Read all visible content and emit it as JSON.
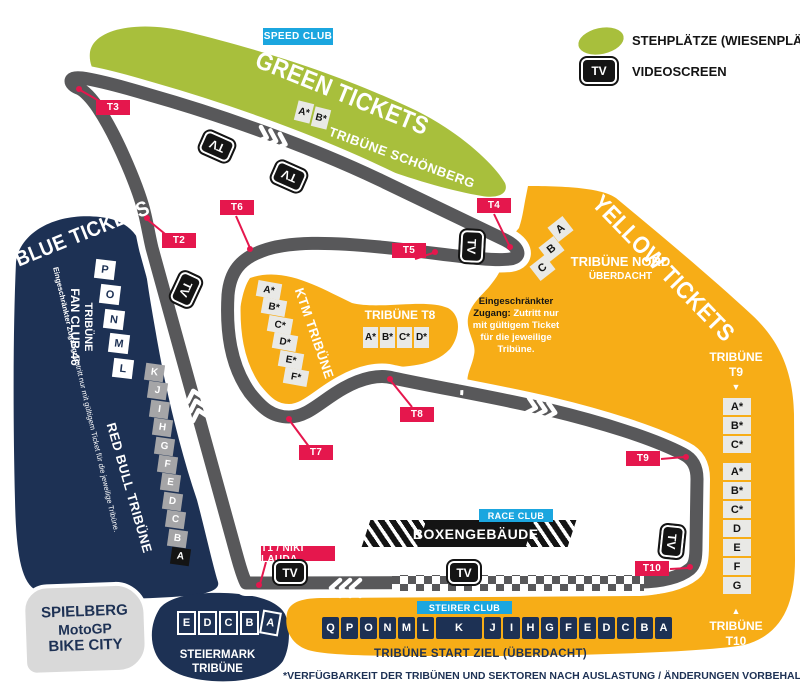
{
  "legend": {
    "standing_label": "STEHPLÄTZE (WIESENPLÄTZE)",
    "videoscreen_label": "VIDEOSCREEN",
    "tv_text": "TV"
  },
  "zones": {
    "green": {
      "title": "GREEN TICKETS",
      "club": "SPEED CLUB",
      "tribune_schoenberg": {
        "name": "TRIBÜNE SCHÖNBERG",
        "sectors": [
          "A*",
          "B*"
        ]
      }
    },
    "blue": {
      "title": "BLUE TICKETS",
      "fan_club": {
        "name_line1": "TRIBÜNE",
        "name_line2": "FAN CLUB 46",
        "sectors": [
          "P",
          "O",
          "N",
          "M",
          "L"
        ]
      },
      "red_bull": {
        "name": "RED BULL TRIBÜNE",
        "sectors": [
          "K",
          "J",
          "I",
          "H",
          "G",
          "F",
          "E",
          "D",
          "C",
          "B",
          "A"
        ]
      },
      "restricted_bold": "Eingeschränkter Zugang:",
      "restricted_rest": " Zutritt nur mit gültigem Ticket für die jeweilige Tribüne."
    },
    "yellow": {
      "title": "YELLOW TICKETS",
      "tribune_nord": {
        "name": "TRIBÜNE NORD",
        "sub": "ÜBERDACHT",
        "sectors": [
          "C",
          "B",
          "A"
        ]
      },
      "ktm": {
        "name": "KTM TRIBÜNE",
        "sectors": [
          "A*",
          "B*",
          "C*",
          "D*",
          "E*",
          "F*"
        ]
      },
      "tribune_t8": {
        "name": "TRIBÜNE T8",
        "sectors": [
          "A*",
          "B*",
          "C*",
          "D*"
        ]
      },
      "tribune_t9": {
        "name": "TRIBÜNE",
        "num": "T9",
        "arrow": "▼",
        "sectors": [
          "A*",
          "B*",
          "C*",
          "A*",
          "B*",
          "C*",
          "D",
          "E",
          "F",
          "G"
        ]
      },
      "tribune_t10": {
        "arrow": "▲",
        "name": "TRIBÜNE",
        "num": "T10"
      },
      "restricted_bold": "Eingeschränkter Zugang:",
      "restricted_rest": " Zutritt nur mit gültigem Ticket für die jeweilige Tribüne.",
      "start_ziel": {
        "club": "STEIRER CLUB",
        "name": "TRIBÜNE START ZIEL (ÜBERDACHT)",
        "sectors": [
          "Q",
          "P",
          "O",
          "N",
          "M",
          "L",
          "K",
          "J",
          "I",
          "H",
          "G",
          "F",
          "E",
          "D",
          "C",
          "B",
          "A"
        ]
      }
    }
  },
  "track": {
    "pit_building": "BOXENGEBÄUDE",
    "race_club": "RACE CLUB",
    "turns": [
      {
        "id": "t1",
        "label": "T1 / NIKI LAUDA"
      },
      {
        "id": "t2",
        "label": "T2"
      },
      {
        "id": "t3",
        "label": "T3"
      },
      {
        "id": "t4",
        "label": "T4"
      },
      {
        "id": "t5",
        "label": "T5"
      },
      {
        "id": "t6",
        "label": "T6"
      },
      {
        "id": "t7",
        "label": "T7"
      },
      {
        "id": "t8",
        "label": "T8"
      },
      {
        "id": "t9",
        "label": "T9"
      },
      {
        "id": "t10",
        "label": "T10"
      }
    ]
  },
  "landmarks": {
    "bike_city": {
      "line1": "SPIELBERG",
      "line2": "MotoGP",
      "line3": "BIKE CITY"
    },
    "steiermark": {
      "name": "STEIERMARK TRIBÜNE",
      "sectors": [
        "E",
        "D",
        "C",
        "B",
        "A"
      ]
    }
  },
  "footer": "*VERFÜGBARKEIT DER TRIBÜNEN UND SEKTOREN NACH AUSLASTUNG / ÄNDERUNGEN VORBEHALTEN",
  "colors": {
    "green": "#a8bf3c",
    "navy": "#1d3154",
    "yellow": "#f7ad17",
    "track_gray": "#58585a",
    "marker_red": "#e5174d",
    "cyan": "#1ba6df",
    "light_gray_box": "#d9d9d9"
  }
}
